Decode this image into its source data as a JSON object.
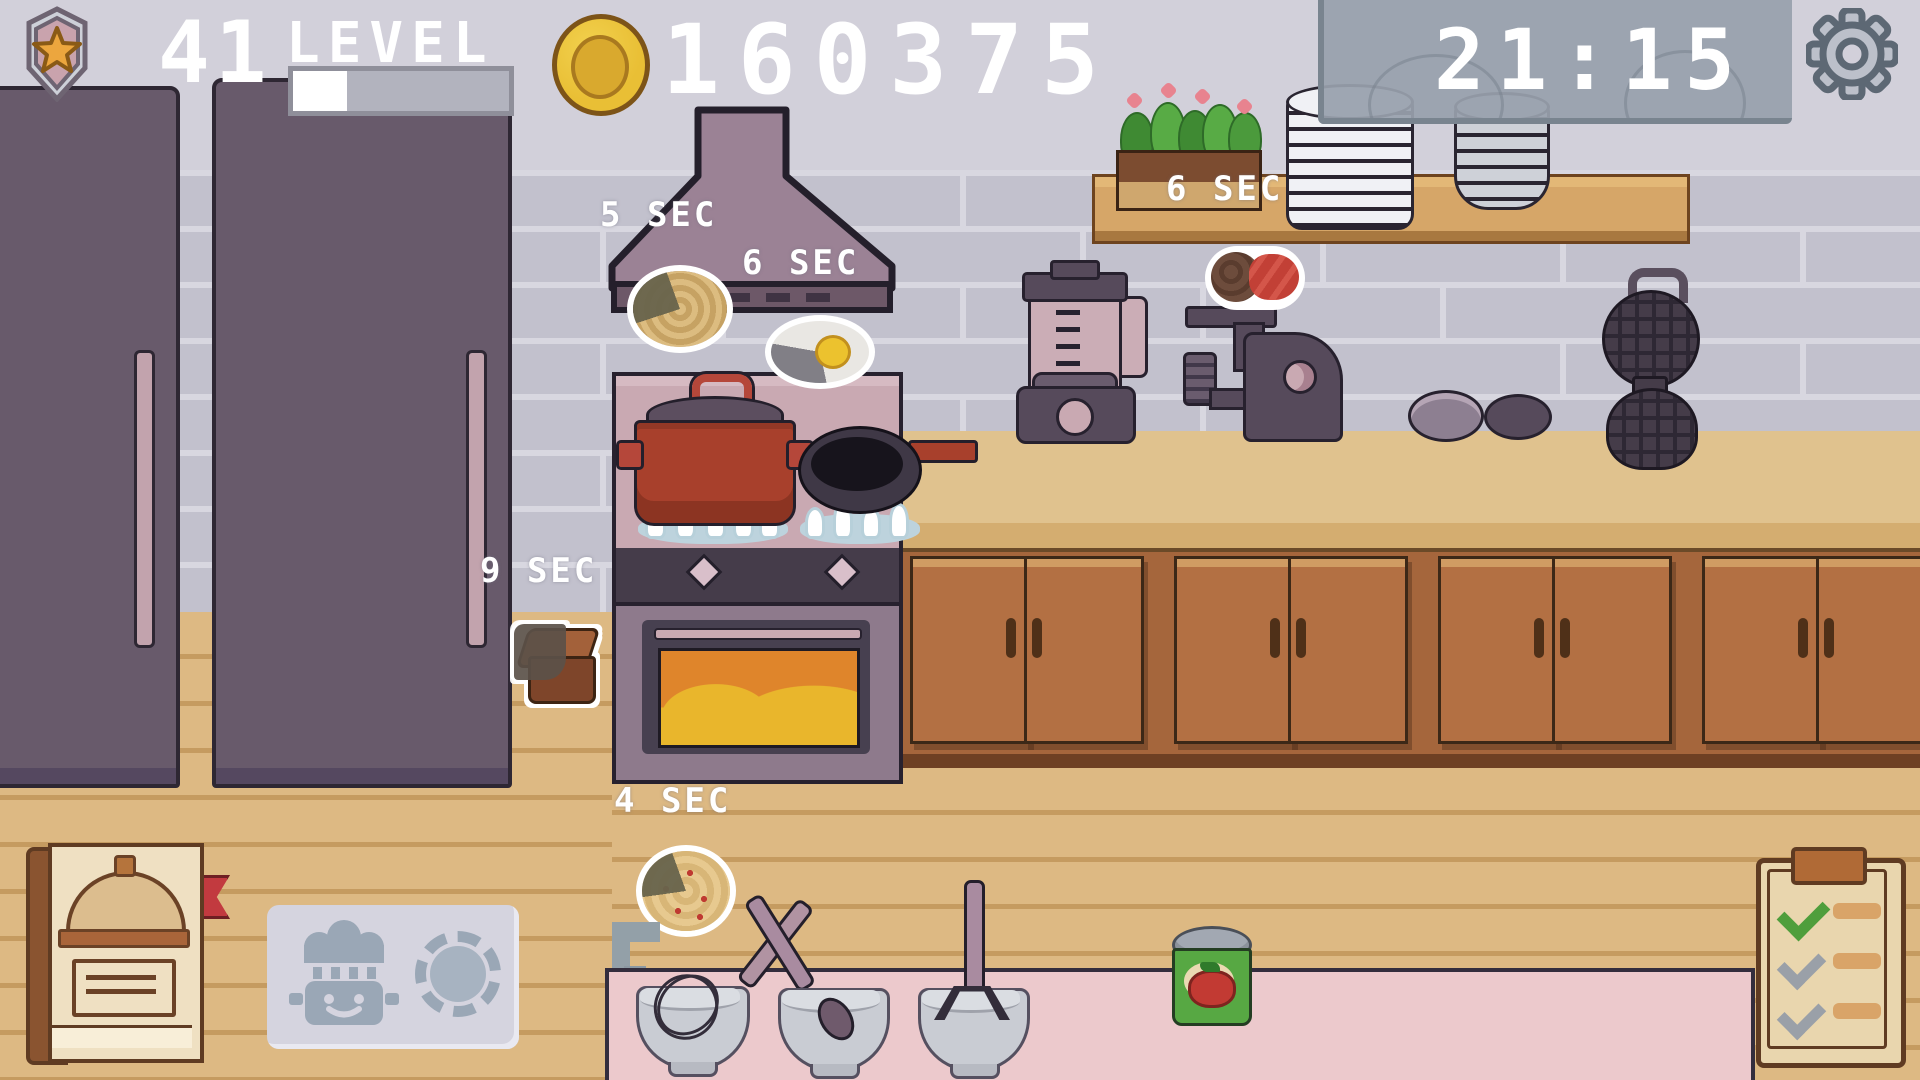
{
  "hud": {
    "badge_icon": "star-badge-icon",
    "level": {
      "value": "41",
      "label": "LEVEL",
      "progress_percent": 25
    },
    "coin_icon": "gold-coin-icon",
    "coins": "160375",
    "clock": "21:15",
    "settings_icon": "gear-icon"
  },
  "cook_timers": {
    "noodles": "5 SEC",
    "fried_egg": "6 SEC",
    "dishes": "6 SEC",
    "chocolate_bread": "9 SEC",
    "pizza": "4 SEC"
  },
  "scene": {
    "appliances": [
      "fridge-left",
      "fridge-right",
      "range-hood",
      "stove-cooktop",
      "oven",
      "blender",
      "meat-grinder",
      "waffle-iron"
    ],
    "props": [
      "soup-pot",
      "frying-pan",
      "plate-stack-large",
      "plate-stack-small",
      "small-plate",
      "small-plate-flipped",
      "flower-planter",
      "shelf",
      "mixing-bowl-whisk",
      "mixing-bowl-spoon",
      "mixing-bowl-masher",
      "tomato-can",
      "recipe-book",
      "station-card-chef-pot",
      "station-card-plate",
      "order-clipboard",
      "sink-hook"
    ]
  },
  "colors": {
    "wall": "#d2d0da",
    "brick": "#c2c1cd",
    "mortar": "#d8d7e0",
    "counter_top": "#e0c28e",
    "cabinet": "#a5663c",
    "floor": "#ddb983",
    "pink_counter": "#ecc9cc",
    "timer_panel": "#98a0ac",
    "hud_text": "#ffffff",
    "coin_gold": "#e9bf35",
    "pot_red": "#a8402c",
    "oven_glow": "#e9b62c",
    "check_green": "#4f9e3c",
    "check_gray": "#9aa0a8"
  }
}
